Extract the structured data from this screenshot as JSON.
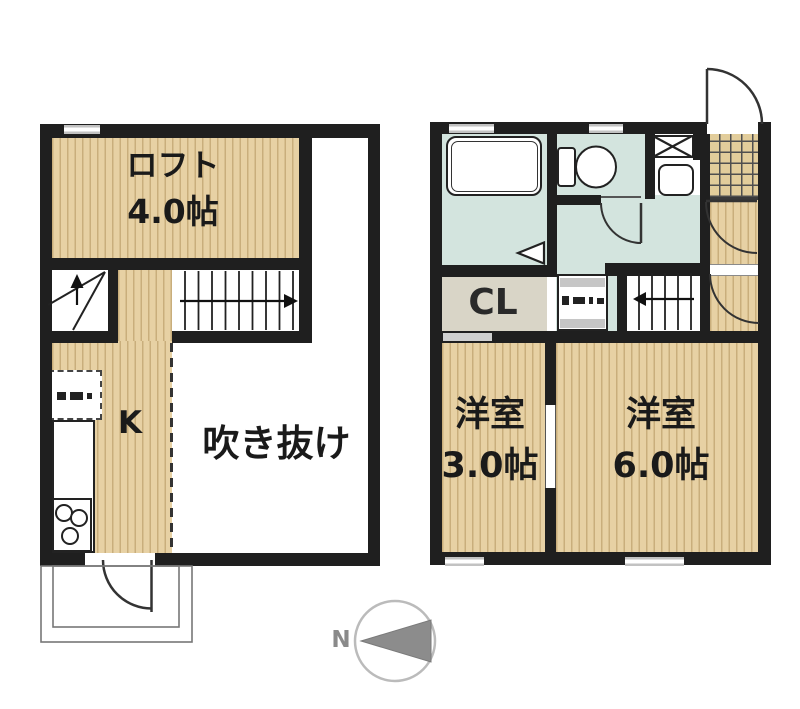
{
  "floor_plan": {
    "upper_floor": {
      "loft": {
        "label": "ロフト",
        "size": "4.0帖"
      },
      "kitchen": {
        "label": "K"
      },
      "void": {
        "label": "吹き抜け"
      }
    },
    "lower_floor": {
      "closet": {
        "label": "CL"
      },
      "bedroom_small": {
        "label": "洋室",
        "size": "3.0帖"
      },
      "bedroom_large": {
        "label": "洋室",
        "size": "6.0帖"
      }
    },
    "compass": {
      "label": "N"
    },
    "colors": {
      "wall": "#1f1f1f",
      "wood_floor": "#e7d1a4",
      "wood_stripe": "#c9ae7c",
      "wet_area": "#d3e4de",
      "closet_fill": "#d9d5c7",
      "tile_fill": "#e2cd9b",
      "window": "#c6c6c6",
      "compass_arrow": "#8c8c8c"
    }
  }
}
